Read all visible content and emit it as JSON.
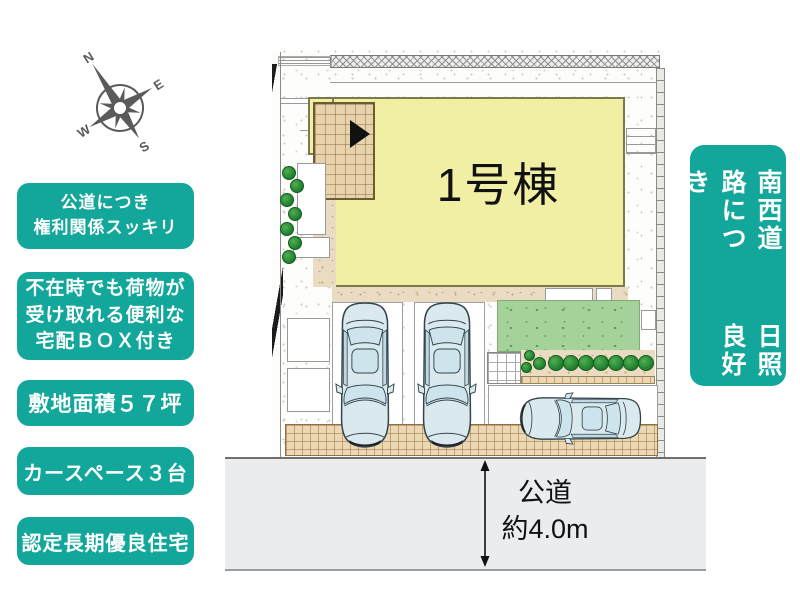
{
  "compass": {
    "north": "N",
    "east": "E",
    "south": "S",
    "west": "W"
  },
  "feature_badges": [
    {
      "lines": [
        "公道につき",
        "権利関係スッキリ"
      ]
    },
    {
      "lines": [
        "不在時でも荷物が",
        "受け取れる便利な",
        "宅配ＢＯＸ付き"
      ]
    },
    {
      "lines": [
        "敷地面積５７坪"
      ]
    },
    {
      "lines": [
        "カースペース３台"
      ]
    },
    {
      "lines": [
        "認定長期優良住宅"
      ]
    }
  ],
  "side_badge": {
    "lines": [
      "南西道路につき",
      "日照良好"
    ]
  },
  "site_plan": {
    "building_label": "1号棟"
  },
  "road": {
    "name": "公道",
    "width_label": "約4.0m"
  },
  "colors": {
    "accent_teal": "#12a79a",
    "building_yellow": "#f1efa3",
    "terrace_tan": "#e8d2ab",
    "lawn_green": "#a5d29a",
    "car_body": "#d9e9ee",
    "road_gray": "#ebecee"
  }
}
